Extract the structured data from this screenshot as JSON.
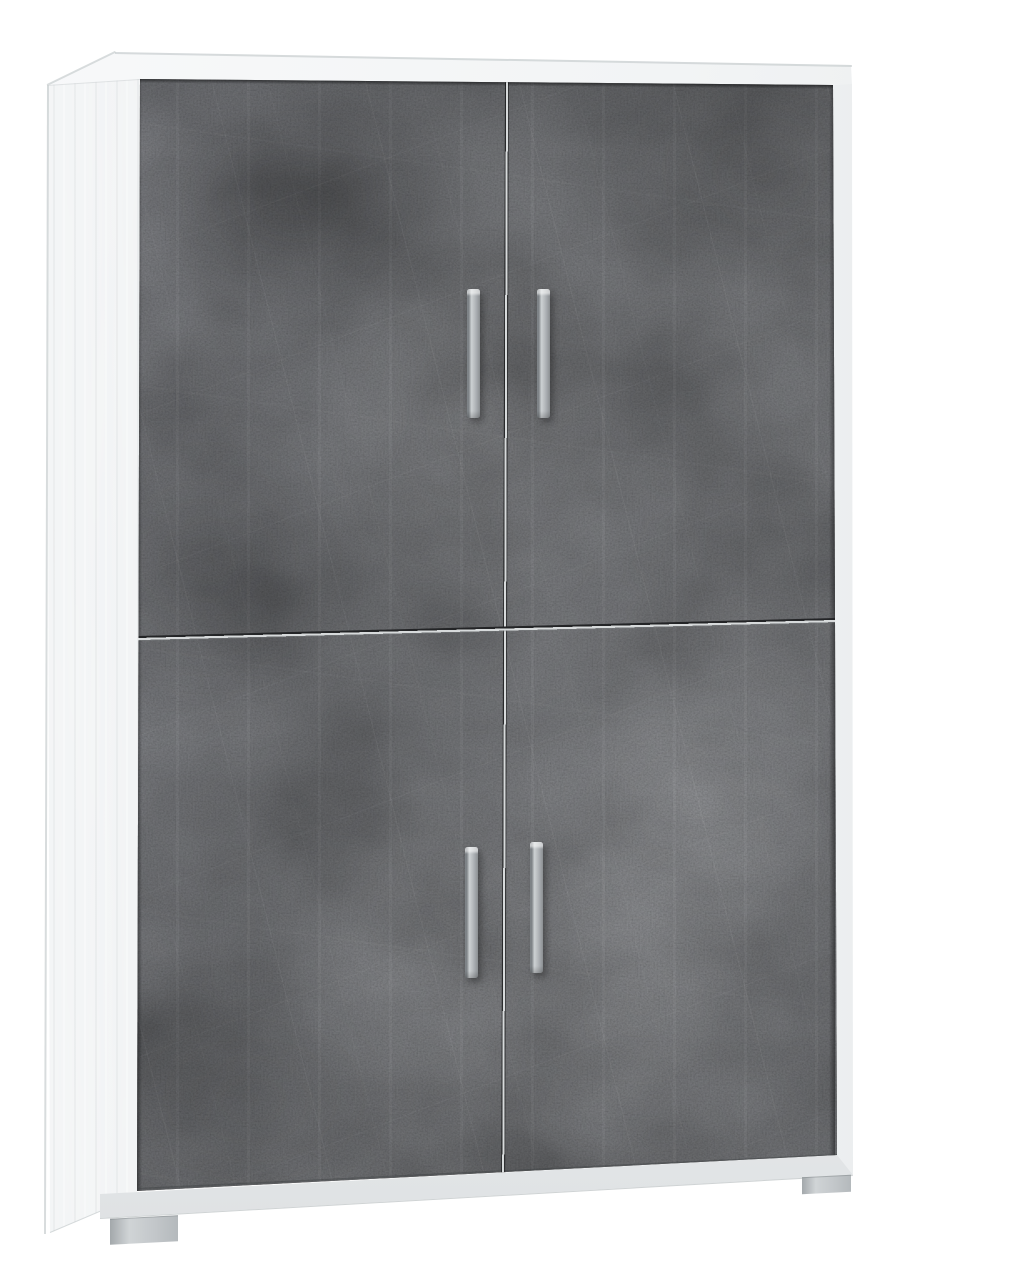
{
  "scene": {
    "type": "product-photo",
    "subject": "Tall four-door storage cabinet, slightly angled three-quarter view on a plain white background",
    "background": "#ffffff"
  },
  "cabinet": {
    "carcass_finish": "light white-concrete effect",
    "door_finish": "dark oxide concrete effect",
    "door_count": 4,
    "doors": [
      {
        "id": "top-left-door"
      },
      {
        "id": "top-right-door"
      },
      {
        "id": "bottom-left-door"
      },
      {
        "id": "bottom-right-door"
      }
    ],
    "handles": [
      {
        "id": "handle-top-left",
        "style": "vertical silver bar"
      },
      {
        "id": "handle-top-right",
        "style": "vertical silver bar"
      },
      {
        "id": "handle-bottom-left",
        "style": "vertical silver bar"
      },
      {
        "id": "handle-bottom-right",
        "style": "vertical silver bar"
      }
    ],
    "feet": [
      {
        "id": "foot-left"
      },
      {
        "id": "foot-right"
      }
    ]
  },
  "colors": {
    "background": "#ffffff",
    "top_face": "#f2f4f5",
    "side_light": "#f4f6f7",
    "side_dark": "#d9dcde",
    "stile": "#f2f4f5",
    "stile_edge": "#c9cdcf",
    "plinth": "#e9ebec",
    "foot": "#c3c7ca",
    "foot_dark": "#a3a8ab",
    "door_base": "#48494b",
    "door_dark": "#464749",
    "door_light": "#4c4d4f",
    "gap_light": "#d7dadb",
    "gap_dark": "#232426",
    "handle_light": "#cdd1d3",
    "handle_mid": "#b4b8bb",
    "handle_dark": "#7e8387"
  }
}
